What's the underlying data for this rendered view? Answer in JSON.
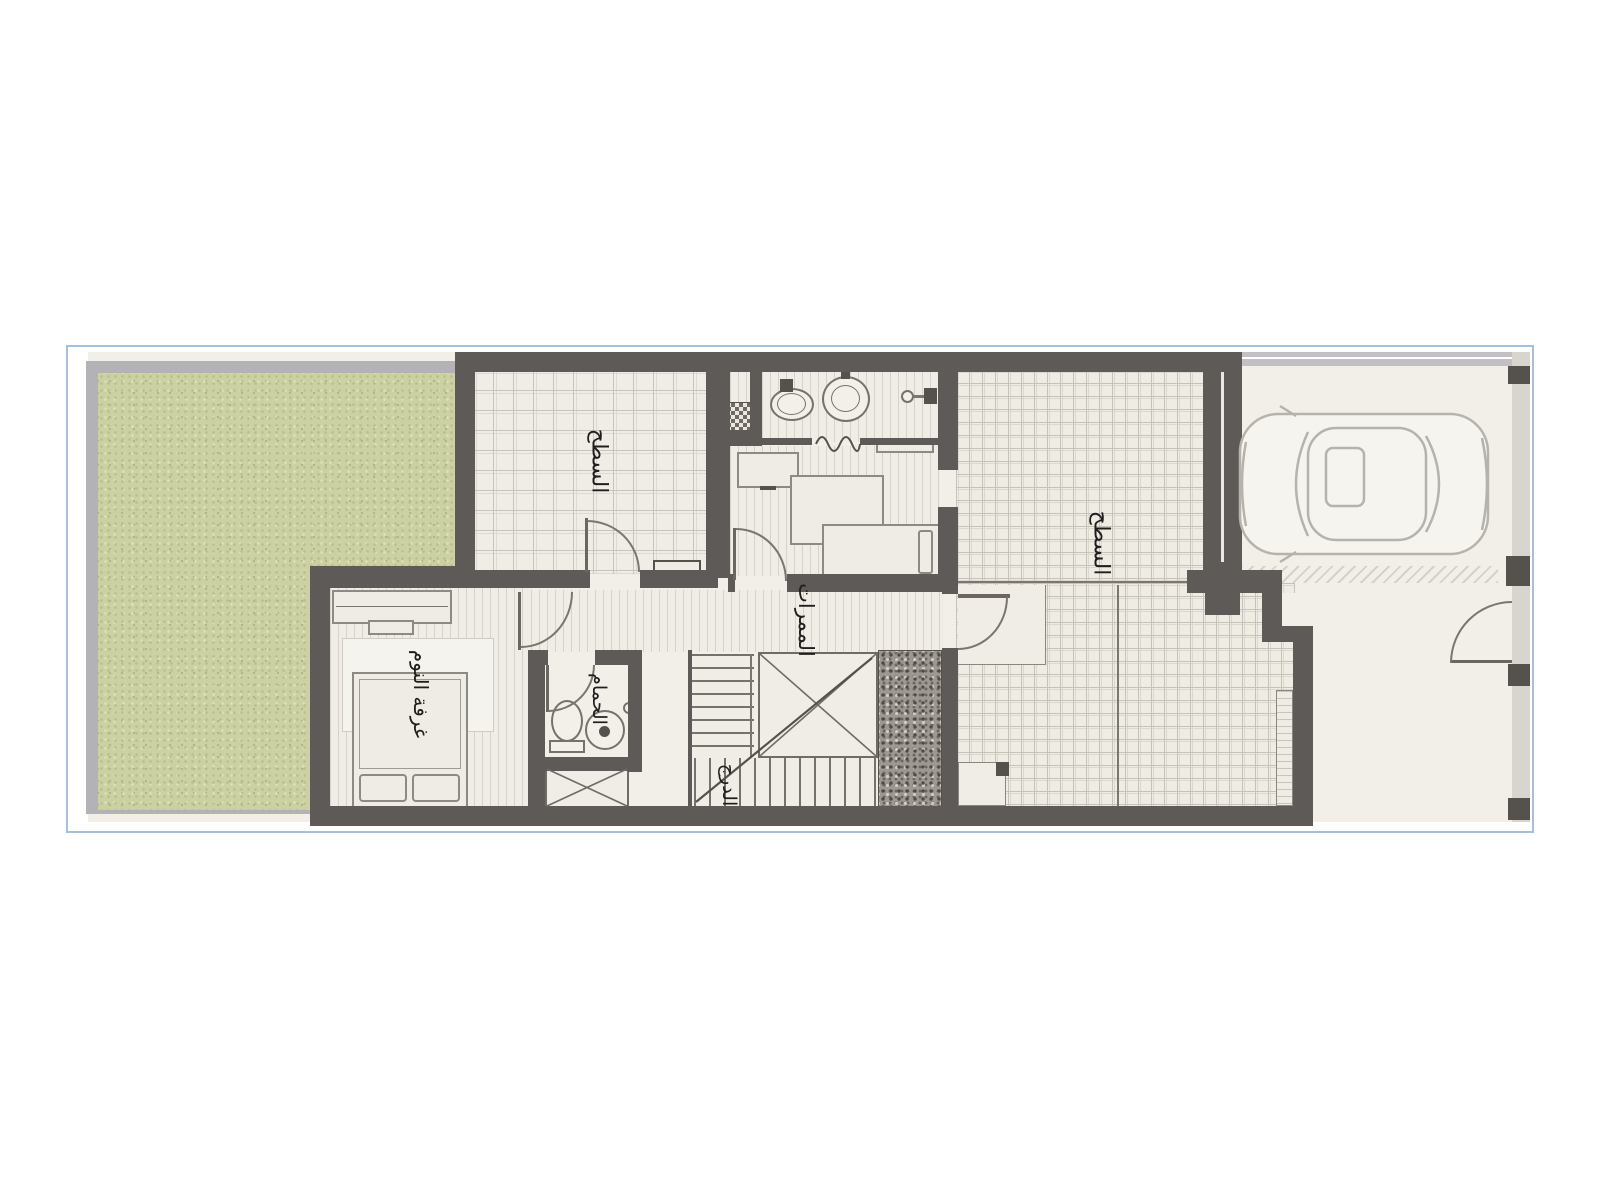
{
  "labels": {
    "terrace_left": "السطح",
    "terrace_right": "السطح",
    "corridors": "الممرات",
    "bedroom": "غرفة النوم",
    "bathroom": "الحمام",
    "stairs": "الدرج"
  },
  "colors": {
    "wall": "#5e5a57",
    "floor": "#f0ede6",
    "tile_grid": "#c8c4bb",
    "garden_green": "#ccd1a4",
    "garden_frame": "#b3b2b6",
    "boundary_blue": "#a6c0dc",
    "pebble_dark": "#6b6660",
    "label_text": "#1f1e1d"
  },
  "icons": {
    "car": "car-top-view-icon",
    "toilet_upper": "toilet-icon",
    "sink_upper": "sink-icon",
    "shower_upper": "shower-icon",
    "toilet_main": "toilet-icon",
    "sink_main": "sink-icon",
    "double_bed": "double-bed-icon",
    "single_bed": "single-bed-icon",
    "wardrobe": "wardrobe-icon",
    "bench": "bench-icon",
    "stair_void": "stair-void-x",
    "shaft": "shaft-x"
  }
}
